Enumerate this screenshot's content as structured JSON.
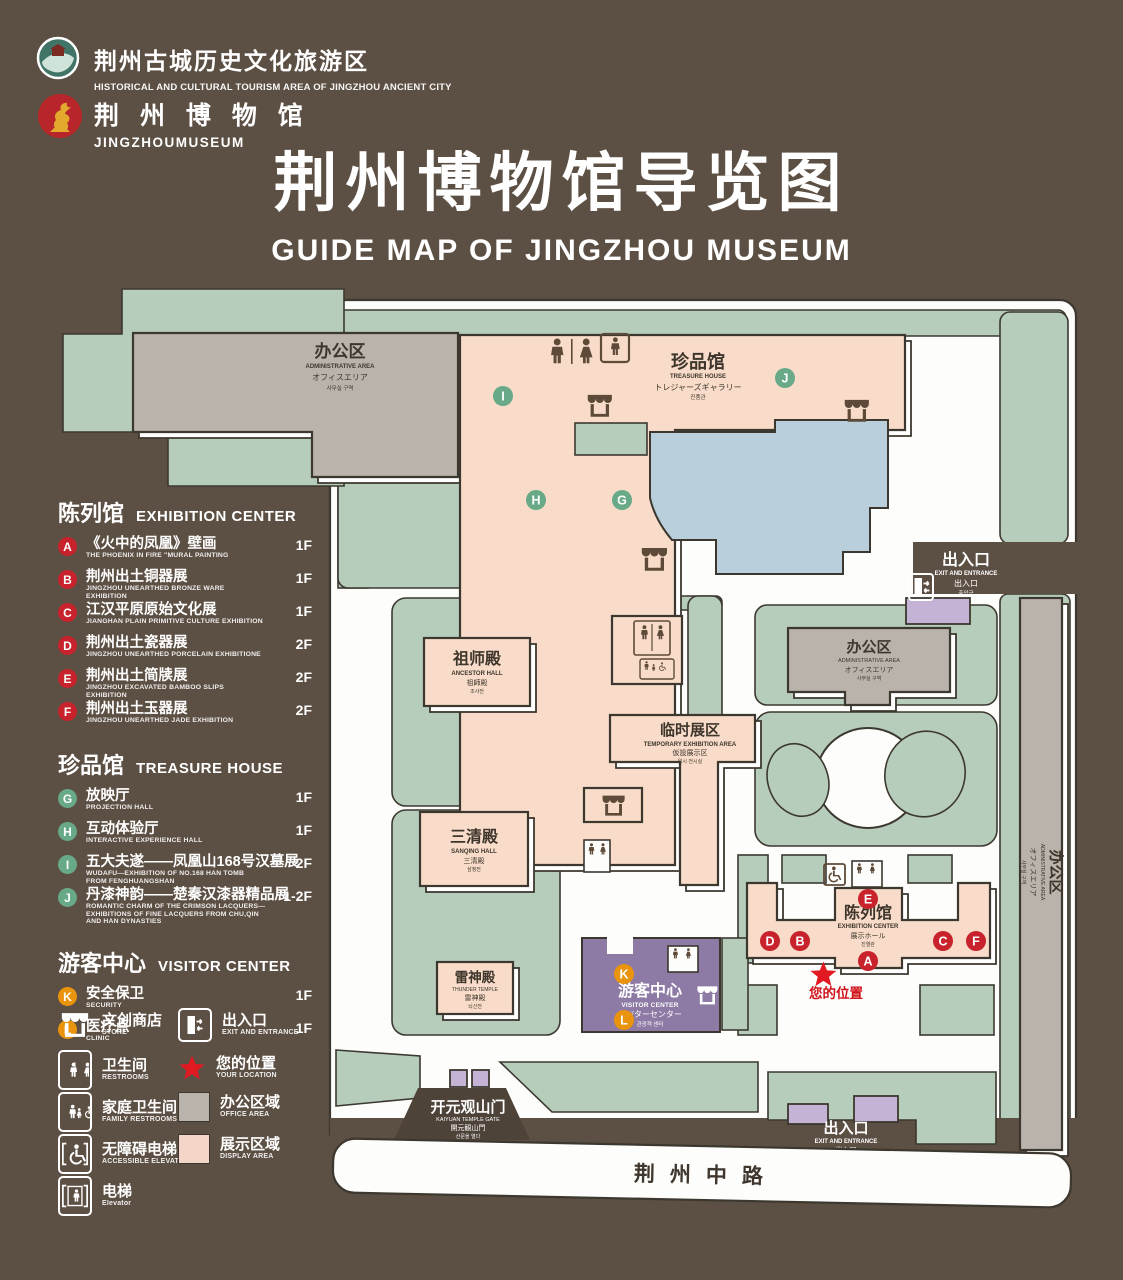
{
  "colors": {
    "background": "#5c4f43",
    "lawn_green": "#b7cdbc",
    "building_pink": "#f8dcc9",
    "building_gray": "#b9b3ab",
    "outline": "#3c382f",
    "lake_blue": "#b9cfdc",
    "visitor_purple": "#8d7aa5",
    "entrance_purple": "#c5b3d6",
    "badge_red": "#c8232c",
    "badge_green": "#68a988",
    "badge_orange": "#e9940c",
    "star_red": "#e11a22"
  },
  "header": {
    "org_logo_cn": "荆州古城历史文化旅游区",
    "org_logo_en": "HISTORICAL AND CULTURAL TOURISM AREA OF JINGZHOU ANCIENT CITY",
    "museum_logo_cn": "荆 州 博 物 馆",
    "museum_logo_en": "JINGZHOUMUSEUM",
    "title_cn": "荆州博物馆导览图",
    "title_en": "GUIDE MAP OF JINGZHOU MUSEUM"
  },
  "legend": {
    "sections": [
      {
        "cn": "陈列馆",
        "en": "EXHIBITION CENTER",
        "items": [
          {
            "letter": "A",
            "cn": "《火中的凤凰》壁画",
            "en": "THE PHOENIX IN FIRE \"MURAL PAINTING",
            "floor": "1F"
          },
          {
            "letter": "B",
            "cn": "荆州出土铜器展",
            "en": "JINGZHOU UNEARTHED BRONZE WARE EXHIBITION",
            "floor": "1F"
          },
          {
            "letter": "C",
            "cn": "江汉平原原始文化展",
            "en": "JIANGHAN PLAIN PRIMITIVE CULTURE EXHIBITION",
            "floor": "1F"
          },
          {
            "letter": "D",
            "cn": "荆州出土瓷器展",
            "en": "JINGZHOU UNEARTHED PORCELAIN EXHIBITIONE",
            "floor": "2F"
          },
          {
            "letter": "E",
            "cn": "荆州出土简牍展",
            "en": "JINGZHOU EXCAVATED BAMBOO SLIPS EXHIBITION",
            "floor": "2F"
          },
          {
            "letter": "F",
            "cn": "荆州出土玉器展",
            "en": "JINGZHOU UNEARTHED JADE EXHIBITION",
            "floor": "2F"
          }
        ]
      },
      {
        "cn": "珍品馆",
        "en": "TREASURE HOUSE",
        "items": [
          {
            "letter": "G",
            "cn": "放映厅",
            "en": "PROJECTION HALL",
            "floor": "1F"
          },
          {
            "letter": "H",
            "cn": "互动体验厅",
            "en": "INTERACTIVE EXPERIENCE HALL",
            "floor": "1F"
          },
          {
            "letter": "I",
            "cn": "五大夫遂——凤凰山168号汉墓展",
            "en": "WUDAFU—EXHIBITION OF NO.168 HAN TOMB FROM FENGHUANGSHAN",
            "floor": "2F"
          },
          {
            "letter": "J",
            "cn": "丹漆神韵——楚秦汉漆器精品展",
            "en": "ROMANTIC CHARM OF THE CRIMSON LACQUERS—EXHIBITIONS OF FINE LACQUERS FROM CHU,QIN AND HAN DYNASTIES",
            "floor": "1-2F"
          }
        ]
      },
      {
        "cn": "游客中心",
        "en": "VISITOR CENTER",
        "items": [
          {
            "letter": "K",
            "cn": "安全保卫",
            "en": "SECURITY",
            "floor": "1F"
          },
          {
            "letter": "L",
            "cn": "医疗点",
            "en": "CLINIC",
            "floor": "1F"
          }
        ]
      }
    ],
    "icons": [
      {
        "cn": "文创商店",
        "en": "STORE"
      },
      {
        "cn": "出入口",
        "en": "EXIT AND ENTRANCE"
      },
      {
        "cn": "卫生间",
        "en": "RESTROOMS"
      },
      {
        "cn": "您的位置",
        "en": "YOUR LOCATION"
      },
      {
        "cn": "家庭卫生间",
        "en": "FAMILY RESTROOMS"
      },
      {
        "cn": "办公区域",
        "en": "OFFICE AREA"
      },
      {
        "cn": "无障碍电梯",
        "en": "ACCESSIBLE ELEVATOR"
      },
      {
        "cn": "展示区域",
        "en": "DISPLAY AREA"
      },
      {
        "cn": "电梯",
        "en": "Elevator"
      }
    ]
  },
  "map": {
    "office": {
      "cn": "办公区",
      "en": "ADMINISTRATIVE AREA",
      "jp": "オフィスエリア",
      "kr": "사무실 구역"
    },
    "treasure": {
      "cn": "珍品馆",
      "en": "TREASURE HOUSE",
      "jp": "トレジャーズギャラリー",
      "kr": "진품관"
    },
    "ancestor": {
      "cn": "祖师殿",
      "en": "ANCESTOR HALL",
      "jp": "祖師殿",
      "kr": "조사전"
    },
    "sanqing": {
      "cn": "三清殿",
      "en": "SANQING HALL",
      "jp": "三清殿",
      "kr": "삼청전"
    },
    "temporary": {
      "cn": "临时展区",
      "en": "TEMPORARY EXHIBITION AREA",
      "jp": "仮設展示区",
      "kr": "임시 전시실"
    },
    "exhibition": {
      "cn": "陈列馆",
      "en": "EXHIBITION CENTER",
      "jp": "展示ホール",
      "kr": "진열관"
    },
    "thunder": {
      "cn": "雷神殿",
      "en": "THUNDER TEMPLE",
      "jp": "雷神殿",
      "kr": "뇌신전"
    },
    "visitor": {
      "cn": "游客中心",
      "en": "VISITOR CENTER",
      "jp": "ビジターセンター",
      "kr": "관광객 센터"
    },
    "gate": {
      "cn": "开元观山门",
      "en": "KAIYUAN TEMPLE GATE",
      "jp": "開元観山門",
      "kr": "산문을 열다"
    },
    "exit": {
      "cn": "出入口",
      "en": "EXIT AND ENTRANCE",
      "jp": "出入口",
      "kr": "출입구"
    },
    "road": "荆州中路",
    "your_location": "您的位置",
    "letters": {
      "a": "A",
      "b": "B",
      "c": "C",
      "d": "D",
      "e": "E",
      "f": "F",
      "g": "G",
      "h": "H",
      "i": "I",
      "j": "J",
      "k": "K",
      "l": "L"
    }
  }
}
